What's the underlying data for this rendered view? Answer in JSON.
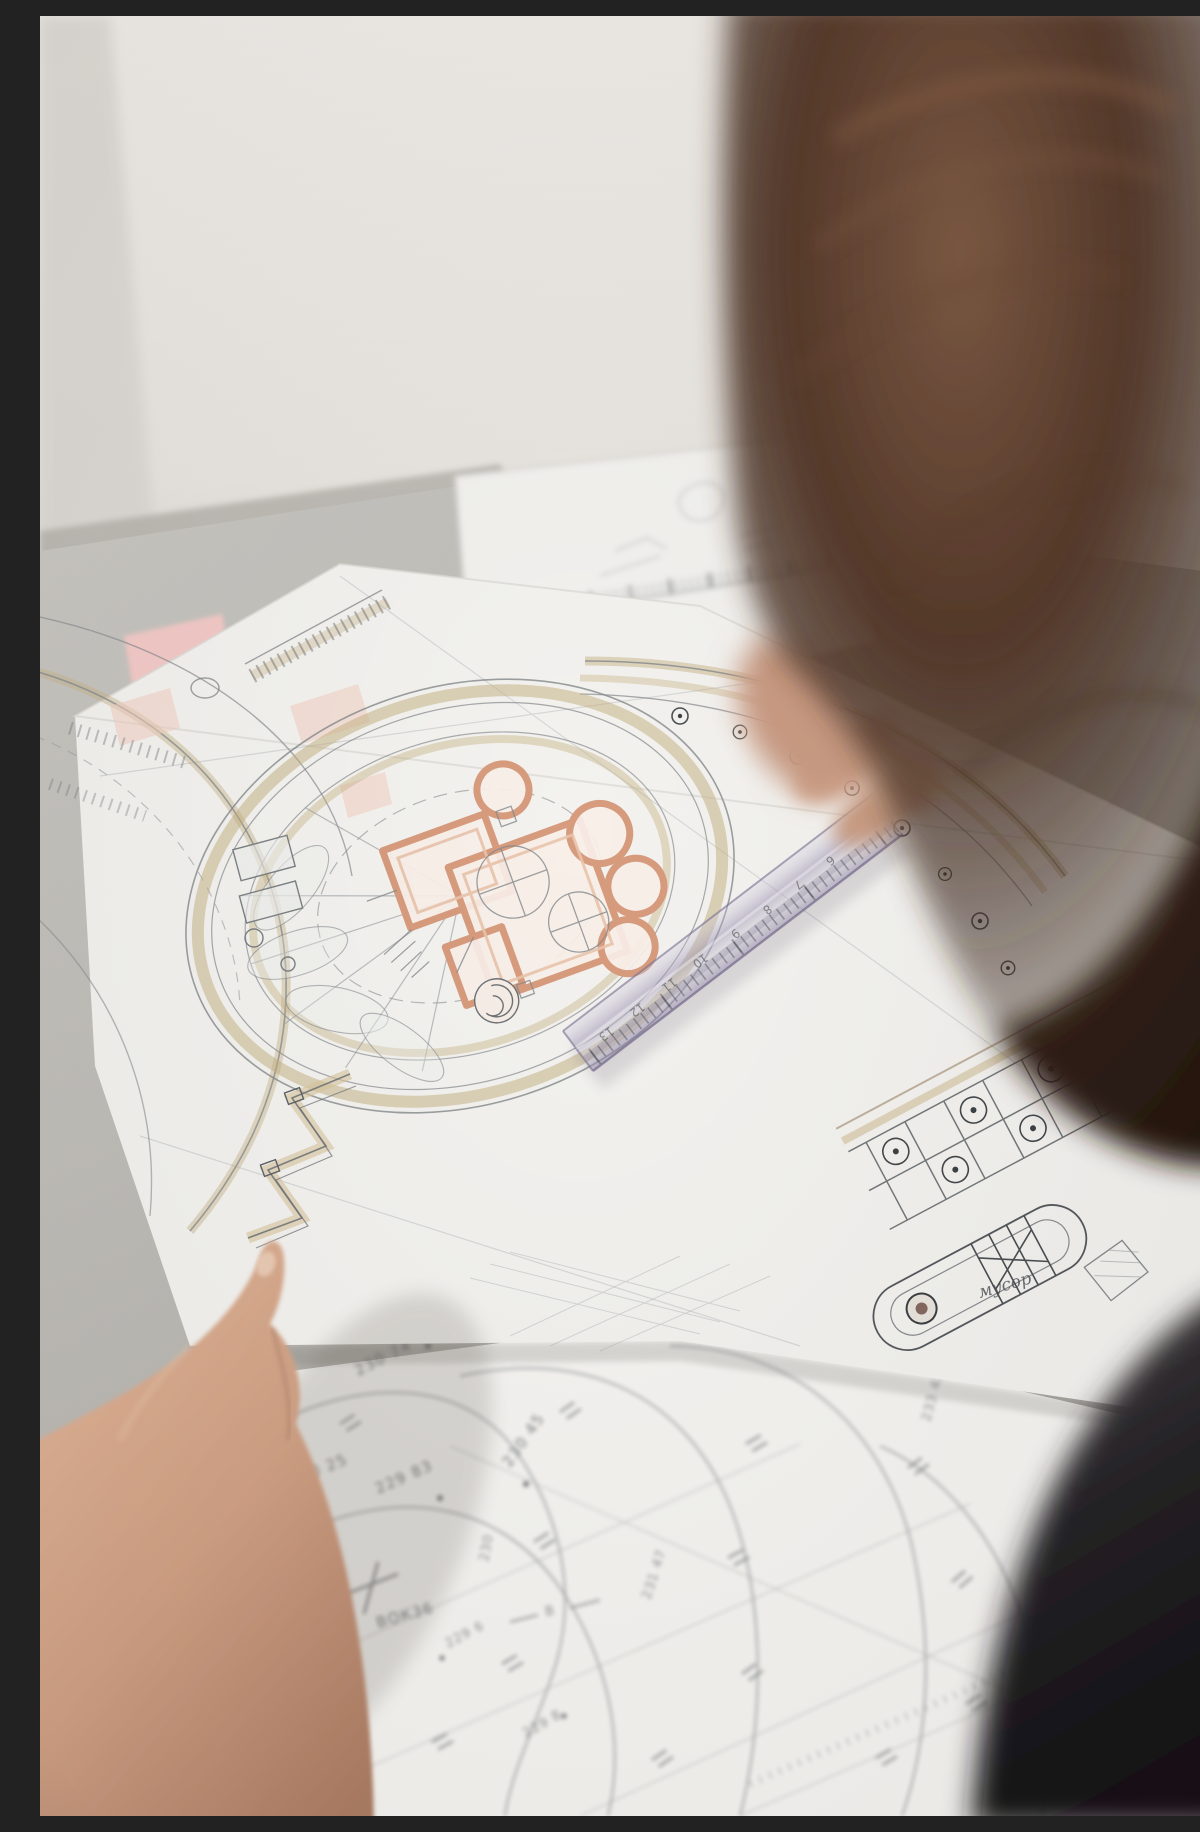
{
  "photo": {
    "description": "Over-the-shoulder photo of a person leaning over hand-drawn landscape architecture site plans on a desk, touching the drawing with one hand and measuring with a transparent ruler",
    "objects": [
      "site-plan-sheet",
      "topographic-survey-sheet",
      "transparent-ruler",
      "left-hand",
      "person-head",
      "pink-sticky-note"
    ]
  },
  "annotations": {
    "elevations": [
      "230 74",
      "230 25",
      "229 83",
      "230 45",
      "231 47",
      "230",
      "229 6",
      "233 43",
      "229 8"
    ],
    "survey_point": "ВОК36",
    "axis_mark": "В",
    "handwritten_note": "мусор"
  },
  "ruler": {
    "numerals": [
      "13",
      "12",
      "11",
      "10",
      "9",
      "8",
      "7",
      "6"
    ]
  },
  "colors": {
    "wall": "#e9e6e1",
    "desk": "#b8b6b1",
    "paper": "#f3f2ef",
    "graphite_line": "#6d7175",
    "terracotta_wall": "#d79b7d",
    "ochre_path": "#c8b488",
    "ruler_tint": "#aaa2bd",
    "hair": "#3c2a21",
    "skin": "#cfa288",
    "sticky_pink": "#f2c9c6"
  }
}
